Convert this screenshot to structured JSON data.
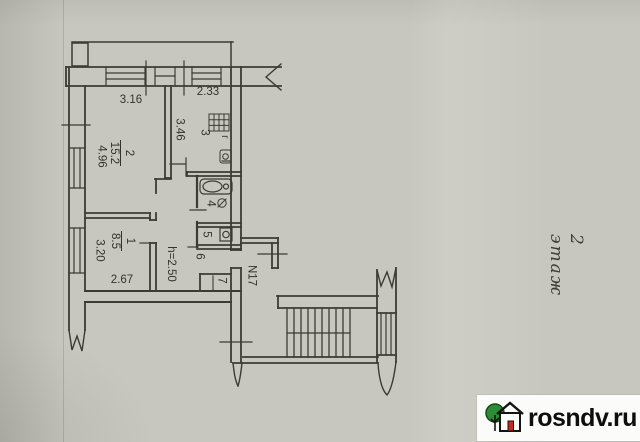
{
  "floor": {
    "label": "2 этаж"
  },
  "watermark": {
    "site": "rosndv.ru"
  },
  "rooms": {
    "r1": {
      "number": "1",
      "area": "8.5"
    },
    "r2": {
      "number": "2",
      "area": "15.2"
    },
    "r3": {
      "number": "3"
    },
    "r4": {
      "number": "4"
    },
    "r5": {
      "number": "5"
    },
    "r6": {
      "number": "6"
    },
    "r7": {
      "number": "7"
    }
  },
  "dimensions": {
    "top_room2": "3.16",
    "top_room3": "2.33",
    "left_room2": "4.96",
    "kitchen_depth": "3.46",
    "left_room1": "3.20",
    "bottom_room1": "2.67",
    "ceiling_height": "h=2.50"
  },
  "annotations": {
    "apartment_number": "N17",
    "gas_mark": "г"
  },
  "colors": {
    "paper": "#c8c7bf",
    "ink": "#3c3b33",
    "logo_green": "#2e8b36",
    "logo_red": "#c8281e"
  }
}
